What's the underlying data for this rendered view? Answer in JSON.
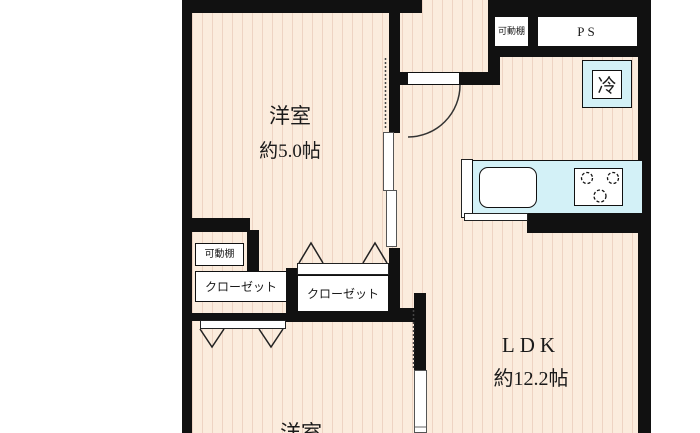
{
  "plan": {
    "room_top": {
      "name": "洋室",
      "size": "約5.0帖"
    },
    "ldk": {
      "name": "LDK",
      "size": "約12.2帖"
    },
    "room_bottom": {
      "name": "洋室"
    },
    "closet_left": {
      "label": "クローゼット"
    },
    "closet_right": {
      "label": "クローゼット"
    },
    "shelf_in_closet": {
      "label": "可動棚"
    },
    "shelf_top": {
      "label": "可動棚"
    },
    "pipe_space": {
      "label": "PS"
    },
    "refrigerator": {
      "label": "冷"
    }
  },
  "colors": {
    "wall": "#111111",
    "floor": "#fbecdd",
    "floor_stripe": "#eed3c2",
    "fixture_cyan": "#d3f1f7",
    "text": "#1a1a1a"
  }
}
